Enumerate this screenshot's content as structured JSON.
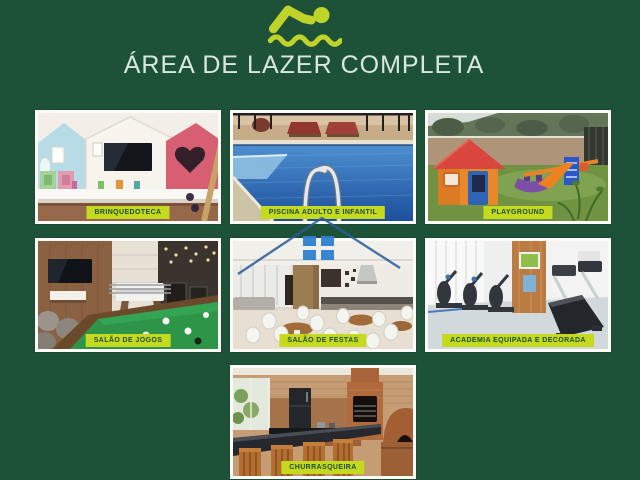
{
  "colors": {
    "background": "#1E5238",
    "accent": "#C5D91F",
    "badge_text": "#1C4D34",
    "title_text": "#D9E8DC",
    "watermark_blue": "#2F80D0"
  },
  "header": {
    "icon": "swimmer",
    "title": "ÁREA DE LAZER COMPLETA"
  },
  "cards": [
    {
      "id": "brinquedoteca",
      "label": "BRINQUEDOTECA",
      "row": 1
    },
    {
      "id": "piscina-adulto-e-infantil",
      "label": "PISCINA ADULTO E INFANTIL",
      "row": 1
    },
    {
      "id": "playground",
      "label": "PLAYGROUND",
      "row": 1
    },
    {
      "id": "salao-de-jogos",
      "label": "SALÃO DE JOGOS",
      "row": 2
    },
    {
      "id": "salao-de-festas",
      "label": "SALÃO DE FESTAS",
      "row": 2
    },
    {
      "id": "academia",
      "label": "ACADEMIA EQUIPADA E DECORADA",
      "row": 2
    },
    {
      "id": "churrasqueira",
      "label": "CHURRASQUEIRA",
      "row": 3
    }
  ],
  "watermark": {
    "shape": "house-outline-with-windows"
  }
}
